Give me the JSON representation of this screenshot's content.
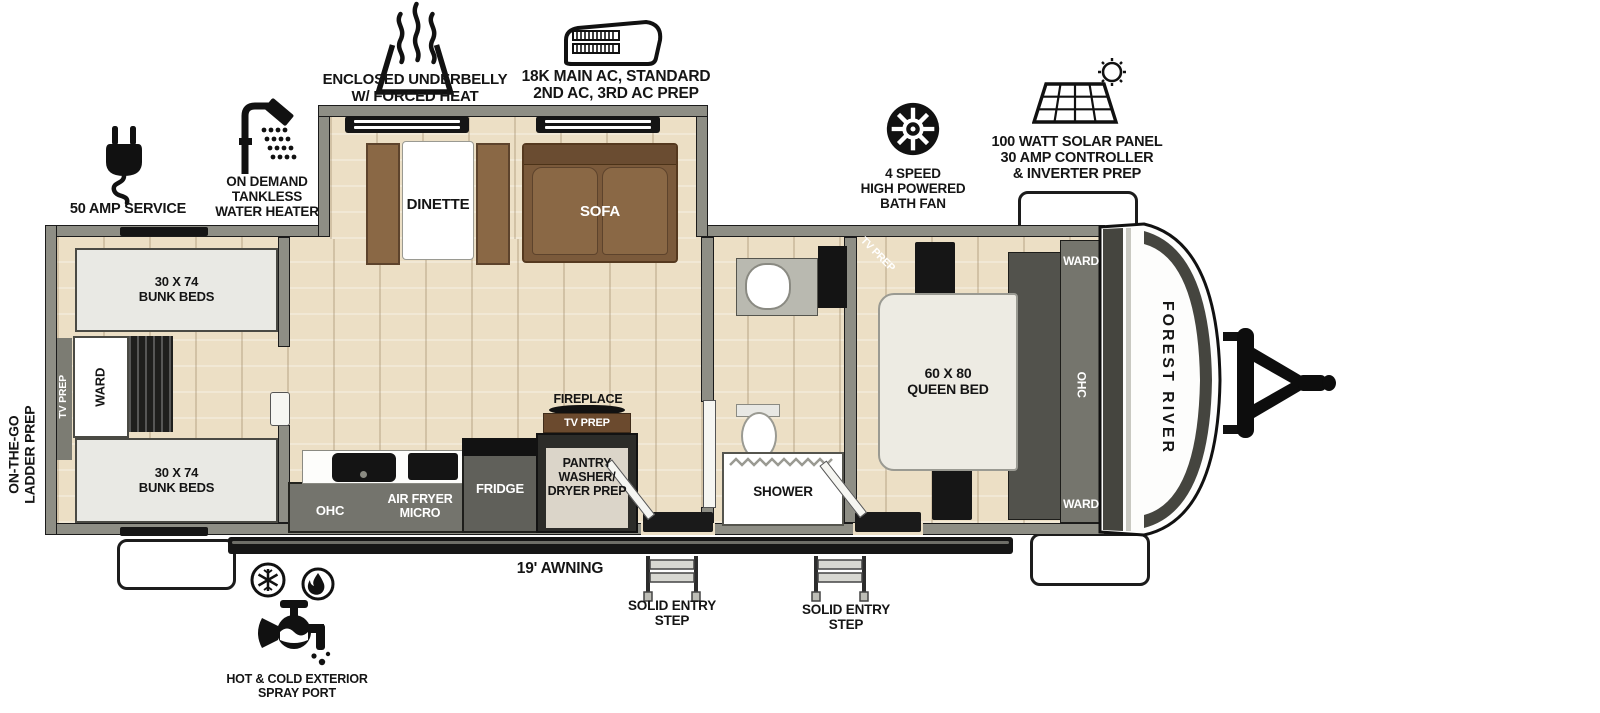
{
  "brand": {
    "name": "FOREST RIVER"
  },
  "callouts": {
    "underbelly": "ENCLOSED UNDERBELLY\nW/ FORCED HEAT",
    "ac": "18K MAIN AC, STANDARD\n2ND AC, 3RD AC PREP",
    "bath_fan": "4 SPEED\nHIGH POWERED\nBATH FAN",
    "solar": "100 WATT SOLAR PANEL\n30 AMP CONTROLLER\n& INVERTER PREP",
    "amp_service": "50 AMP SERVICE",
    "water_heater": "ON DEMAND\nTANKLESS\nWATER HEATER",
    "ladder_prep": "ON-THE-GO\nLADDER PREP",
    "spray_port": "HOT & COLD EXTERIOR\nSPRAY PORT",
    "awning": "19' AWNING",
    "entry_step_1": "SOLID ENTRY\nSTEP",
    "entry_step_2": "SOLID ENTRY\nSTEP"
  },
  "rooms": {
    "bunkroom": {
      "tv_prep": "TV PREP",
      "bunk_top": "30 X 74\nBUNK BEDS",
      "bunk_bottom": "30 X 74\nBUNK BEDS",
      "ward": "WARD"
    },
    "living": {
      "dinette": "DINETTE",
      "sofa": "SOFA"
    },
    "kitchen": {
      "ohc": "OHC",
      "air_fryer_micro": "AIR FRYER\nMICRO",
      "fridge": "FRIDGE",
      "pantry": "PANTRY\nWASHER/\nDRYER PREP",
      "fireplace": "FIREPLACE",
      "tv_prep": "TV PREP"
    },
    "bathroom": {
      "shower": "SHOWER"
    },
    "bedroom": {
      "tv_prep": "TV PREP",
      "queen_bed": "60 X 80\nQUEEN BED",
      "ward_top": "WARD",
      "ohc": "OHC",
      "ward_bottom": "WARD"
    }
  },
  "colors": {
    "wall": "#8e8e85",
    "floor": "#ecdfc5",
    "wood": "#7d5c3d",
    "line": "#1b1b1b"
  }
}
